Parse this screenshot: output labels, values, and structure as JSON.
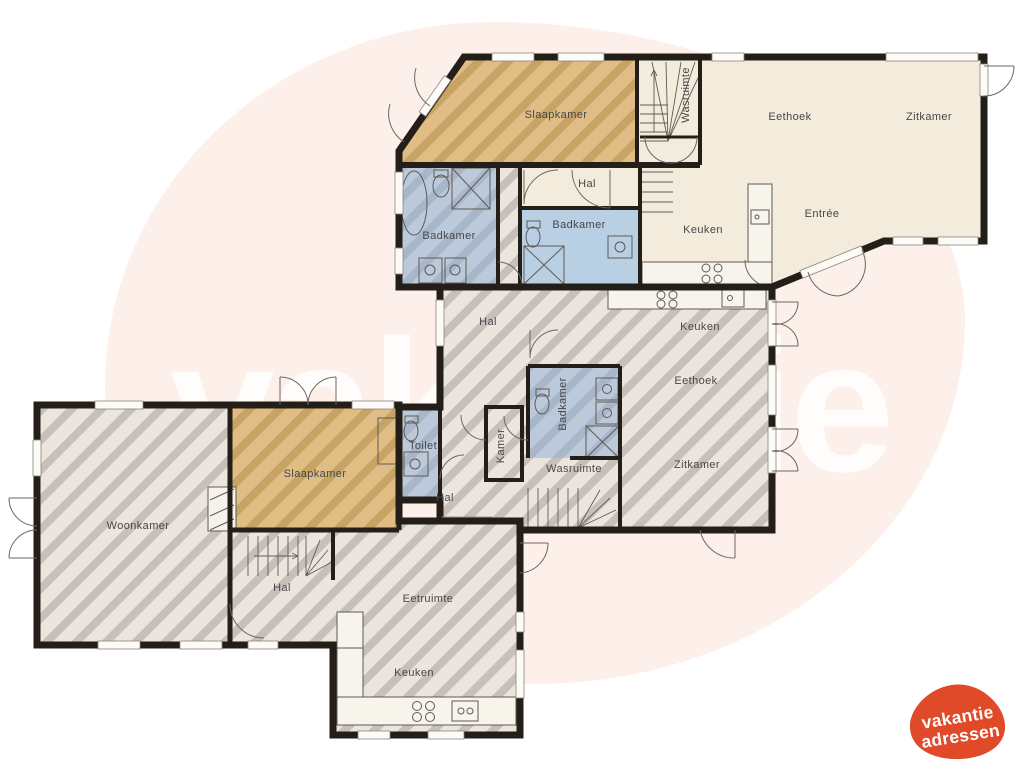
{
  "watermark": {
    "text": "vakantie"
  },
  "logo": {
    "line1": "vakantie",
    "line2": "adressen",
    "color": "#e04a28"
  },
  "colors": {
    "wall": "#241e19",
    "room_cream": "#f3ecdc",
    "room_grey_hatch": "#ece5de",
    "room_grey_stripe": "#c7bfb9",
    "room_tan_hatch": "#dfbd85",
    "room_tan_stripe": "#c7a364",
    "room_blue_hatch": "#bcc9da",
    "room_blue_stripe": "#a8b6ca",
    "room_blue_solid": "#b9cfe3",
    "background_blob": "#fdf0ea"
  },
  "rooms": {
    "top_slaapkamer": "Slaapkamer",
    "top_wasruimte": "Wasruimte",
    "top_hal": "Hal",
    "top_badkamer_left": "Badkamer",
    "top_badkamer_blue": "Badkamer",
    "top_keuken": "Keuken",
    "top_eethoek": "Eethoek",
    "top_zitkamer": "Zitkamer",
    "top_entree": "Entrée",
    "mid_hal_upper": "Hal",
    "mid_keuken": "Keuken",
    "mid_eethoek": "Eethoek",
    "mid_zitkamer": "Zitkamer",
    "mid_badkamer": "Badkamer",
    "mid_wasruimte": "Wasruimte",
    "mid_toilet": "Toilet",
    "mid_kamer": "Kamer",
    "mid_hal_lower": "Hal",
    "bottom_woonkamer": "Woonkamer",
    "bottom_slaapkamer": "Slaapkamer",
    "bottom_hal": "Hal",
    "bottom_eetruimte": "Eetruimte",
    "bottom_keuken": "Keuken"
  }
}
